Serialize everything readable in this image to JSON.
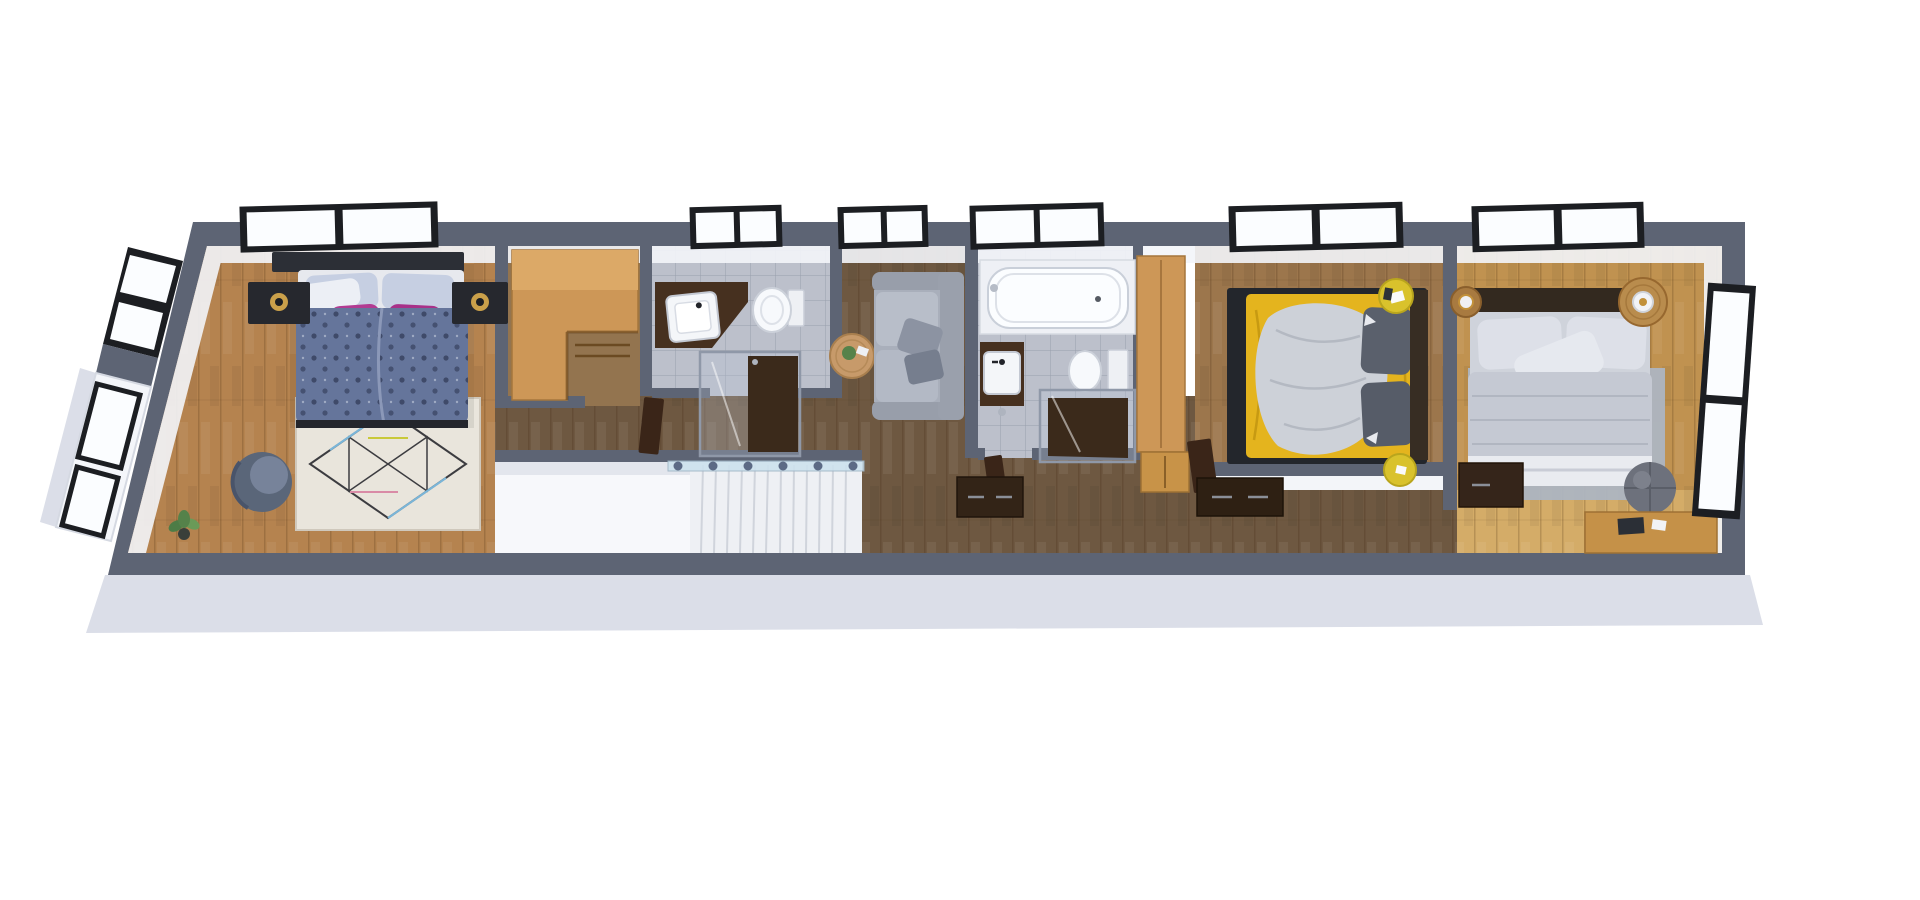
{
  "scene": {
    "type": "3d-floorplan-render",
    "view": "top-down dollhouse perspective",
    "background": "#ffffff",
    "floor_label": "upper floor with three bedrooms, two bathrooms, walk-in closet, sitting area and staircase"
  },
  "palette": {
    "bg": "#ffffff",
    "wall": "#5d6474",
    "slab": "#dbdee8",
    "face": "#f3f5f9",
    "frame": "#1c1e22",
    "glasswhite": "#fbfdff",
    "tile": "#bcc0cb",
    "floorWarm": "#b5834f",
    "floorMid": "#93744f",
    "floorDark": "#6e5841",
    "floorBed2": "#9c764c",
    "floorBed3": "#c09250",
    "floorBed3S": "#d4ac68",
    "tan": "#cd9757",
    "tanLight": "#dca967",
    "darkwood": "#46301f",
    "door": "#3a2518",
    "bedBlue": "#65759b",
    "pillowBlue": "#c6cfe2",
    "accentPink": "#b23b92",
    "furnDark": "#26282e",
    "lampGold": "#caa04a",
    "sofaGray": "#a9afbb",
    "bedYellow": "#e4b41e",
    "duvetGray": "#cdd1d8",
    "pillowDark": "#5a606c",
    "headBrown": "#372d23",
    "tableYellow": "#d9c22c",
    "bedGray": "#cfd3db",
    "rugGray": "#adb5c1",
    "pouf": "#6d717c",
    "desk": "#c59148",
    "glassRail": "#cde2ee",
    "stairWhite": "#f7f8fb"
  },
  "rooms": [
    {
      "name": "bedroom-1",
      "position": "far left",
      "floor": "medium oak plank",
      "furniture": [
        "double-bed-blue-tufted-duvet",
        "two-light-blue-pillows",
        "two-pink-accent-pillows",
        "dark-nightstand-left",
        "dark-nightstand-right",
        "gold-table-lamps",
        "geometric-diamond-rug",
        "gray-armchair",
        "potted-plant"
      ],
      "windows": [
        "north-double-window",
        "west-double-window",
        "west-bay-window"
      ]
    },
    {
      "name": "walk-in-closet",
      "position": "left of center",
      "floor": "oak",
      "furniture": [
        "l-shaped-wardrobe-counter"
      ],
      "windows": []
    },
    {
      "name": "bathroom-1",
      "position": "center-left",
      "floor": "gray tile",
      "furniture": [
        "corner-vanity-with-square-sink",
        "toilet",
        "glass-shower-dark-floor",
        "open-door"
      ],
      "windows": [
        "north-window"
      ]
    },
    {
      "name": "sitting-area",
      "position": "center",
      "floor": "dark walnut plank",
      "furniture": [
        "gray-sofa-facing-west",
        "round-coffee-table-with-plant"
      ],
      "windows": [
        "north-window"
      ]
    },
    {
      "name": "stairwell",
      "position": "center-south",
      "furniture": [
        "white-staircase-descending",
        "glass-balustrade-with-posts"
      ],
      "windows": []
    },
    {
      "name": "bathroom-2",
      "position": "center-right",
      "floor": "gray tile",
      "furniture": [
        "built-in-bathtub",
        "dark-vanity-with-sink",
        "toilet",
        "glass-shower-dark-floor",
        "open-door"
      ],
      "windows": [
        "north-double-window"
      ]
    },
    {
      "name": "bedroom-2",
      "position": "right of center",
      "floor": "walnut plank",
      "furniture": [
        "double-bed-yellow-sheets-gray-throw",
        "two-dark-gray-pillows",
        "dark-headboard-east",
        "yellow-round-side-table-north",
        "yellow-round-side-table-south",
        "tall-oak-wardrobe-column",
        "oak-dresser"
      ],
      "windows": [
        "north-double-window"
      ]
    },
    {
      "name": "bedroom-3",
      "position": "far right",
      "floor": "light oak plank",
      "furniture": [
        "double-bed-gray-duvet",
        "round-wood-nightstand-left",
        "round-wood-nightstand-right",
        "white-gold-lamps",
        "gray-rug",
        "dark-gray-pouf",
        "dark-dresser",
        "oak-desk"
      ],
      "windows": [
        "north-double-window",
        "east-double-window"
      ]
    },
    {
      "name": "hallway",
      "position": "south corridor",
      "floor": "dark walnut plank",
      "furniture": [
        "dark-dresser-by-bathroom-2",
        "dark-dresser-by-bedroom-2"
      ],
      "windows": []
    }
  ]
}
